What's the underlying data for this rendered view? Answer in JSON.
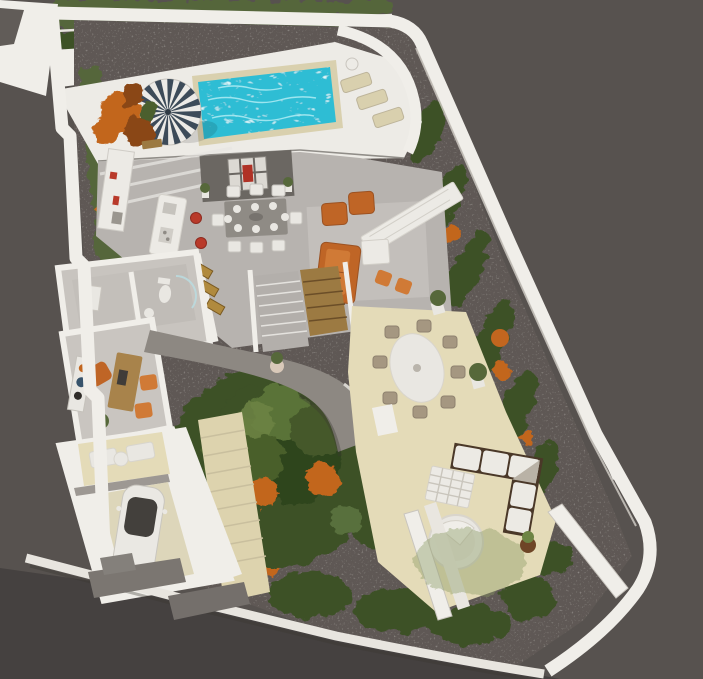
{
  "scene": {
    "description": "3D isometric architectural render of a villa floor plan on an irregular plot",
    "view": "aerial top-down 3D visualization",
    "rooms": [
      "pool deck",
      "kitchen",
      "dining area",
      "living room",
      "hallway",
      "bathroom",
      "office",
      "garage",
      "central garden",
      "outdoor patio"
    ]
  },
  "palette": {
    "bg": "#57524f",
    "street": "#454140",
    "curb": "#e8e5df",
    "wall_white": "#f0eee9",
    "wall_shadow": "#d5d1c9",
    "gravel": "#5e5954",
    "grass_dark": "#3e5128",
    "grass_mid": "#55663a",
    "grass_light": "#7e8f58",
    "foliage_deep": "#2f441f",
    "flower_orange": "#c2661f",
    "flower_dark": "#8a4616",
    "pool_water": "#2fbdd4",
    "pool_ripple": "#b9f0f6",
    "pool_coping": "#d9d0ae",
    "deck": "#edebe6",
    "umbrella_navy": "#3d4b59",
    "umbrella_white": "#eceae6",
    "floor_indoor": "#b7b3af",
    "rug": "#c4c0bc",
    "feature_wall": "#6b6762",
    "art_red": "#b03226",
    "art_panel": "#dcd9d3",
    "table_gray": "#8f8b85",
    "chair_white": "#e9e7e2",
    "sofa_orange": "#bf6526",
    "sofa_seat": "#d07a36",
    "stool_red": "#b93a2a",
    "wood": "#9c7a42",
    "sideboard": "#eceae5",
    "patio_beige": "#e4dbb8",
    "patio_steps": "#ddd3ae",
    "patio_chair": "#a59781",
    "walkway": "#8d8882",
    "driveway": "#7b7671",
    "car_white": "#eae8e3",
    "car_glass": "#43403c",
    "lsofa_frame": "#4a3828",
    "lsofa_cushion": "#eceae4",
    "room_floor": "#c8c4bf",
    "office_floor": "#c9c5c0",
    "desk_wood": "#a8834b",
    "art_gold": "#b08a3e",
    "planter": "#e9e7e1",
    "plant_green": "#56683a"
  },
  "inventory": {
    "pools": 1,
    "umbrellas": 1,
    "pool_loungers": 3,
    "dining_seats": 8,
    "bar_stools": 2,
    "orange_armchairs": 2,
    "orange_sofas": 1,
    "orange_poufs": 2,
    "office_chairs": 3,
    "patio_dining_chairs": 8,
    "outdoor_l_sofas": 1,
    "round_daybeds": 1,
    "cars": 1,
    "large_trees": 1
  }
}
